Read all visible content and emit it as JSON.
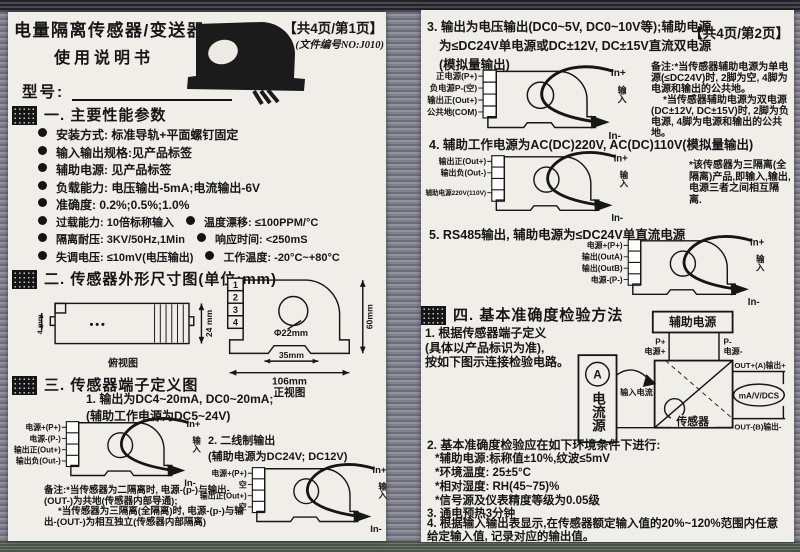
{
  "p1": {
    "title": "电量隔离传感器/变送器",
    "subtitle": "使用说明书",
    "badge": "【共4页/第1页】",
    "docno": "(文件编号NO:J010)",
    "model": "型号:",
    "s1": {
      "h": "一. 主要性能参数",
      "r1": "安装方式: 标准导轨+平面螺钉固定",
      "r2": "输入输出规格:见产品标签",
      "r3": "辅助电源: 见产品标签",
      "r4": "负载能力: 电压输出-5mA;电流输出-6V",
      "r5": "准确度: 0.2%;0.5%;1.0%",
      "r6a": "过载能力: 10倍标称输入",
      "r6b": "温度漂移: ≤100PPM/°C",
      "r7a": "隔离耐压: 3KV/50Hz,1Min",
      "r7b": "响应时间: <250mS",
      "r8a": "失调电压: ≤10mV(电压输出)",
      "r8b": "工作温度: -20°C~+80°C"
    },
    "s2": {
      "h": "二. 传感器外形尺寸图(单位:mm)",
      "side": {
        "d1": "4 mm",
        "d2": "24 mm",
        "cap": "俯视图"
      },
      "front": {
        "hole": "Φ22mm",
        "notch": "35mm",
        "w": "106mm",
        "h": "60mm",
        "cap": "正视图",
        "t1": "1",
        "t2": "2",
        "t3": "3",
        "t4": "4"
      }
    },
    "s3": {
      "h": "三. 传感器端子定义图",
      "d1": {
        "t1": "1. 输出为DC4~20mA, DC0~20mA;",
        "t2": "(辅助工作电源为DC5~24V)",
        "p1": "电源+(P+)",
        "p2": "电源-(P-)",
        "p3": "输出正(Out+)",
        "p4": "输出负(Out-)",
        "inp": "In+",
        "inm": "In-",
        "dir": "输入",
        "n1": "备注:*当传感器为二隔离时, 电源-(p-)与输出-(OUT-)为共地(传感器内部导通);",
        "n2": "*当传感器为三隔离(全隔离)时, 电源-(p-)与输出-(OUT-)为相互独立(传感器内部隔离)"
      },
      "d2": {
        "t1": "2. 二线制输出",
        "t2": "(辅助电源为DC24V; DC12V)",
        "p1": "电源+(P+)",
        "p2": "空",
        "p3": "输出正(Out+)",
        "p4": "空",
        "inp": "In+",
        "inm": "In-",
        "dir": "输入"
      }
    }
  },
  "p2": {
    "badge": "【共4页/第2页】",
    "d3": {
      "t1": "3. 输出为电压输出(DC0~5V, DC0~10V等);辅助电源",
      "t2": "为≤DC24V单电源或DC±12V, DC±15V直流双电源",
      "t3": "(模拟量输出)",
      "p1": "正电源(P+)",
      "p2": "负电源P-(空)",
      "p3": "输出正(Out+)",
      "p4": "公共地(COM)",
      "inp": "In+",
      "inm": "In-",
      "dir": "输入",
      "n1": "备注:*当传感器辅助电源为单电源(≤DC24V)时, 2脚为空, 4脚为电源和输出的公共地。",
      "n2": "*当传感器辅助电源为双电源(DC±12V, DC±15V)时, 2脚为负电源, 4脚为电源和输出的公共地。"
    },
    "d4": {
      "t1": "4. 辅助工作电源为AC(DC)220V, AC(DC)110V(模拟量输出)",
      "p1": "输出正(Out+)",
      "p2": "输出负(Out-)",
      "p3": "辅助电源220V(110V)",
      "inp": "In+",
      "inm": "In-",
      "dir": "输入",
      "n1": "*该传感器为三隔离(全隔离)产品,即输入,输出,电源三者之间相互隔离."
    },
    "d5": {
      "t1": "5. RS485输出, 辅助电源为≤DC24V单直流电源",
      "p1": "电源+(P+)",
      "p2": "输出(OutA)",
      "p3": "输出(OutB)",
      "p4": "电源-(P-)",
      "inp": "In+",
      "inm": "In-",
      "dir": "输入"
    },
    "s4": {
      "h": "四. 基本准确度检验方法",
      "i1a": "1. 根据传感器端子定义",
      "i1b": "(具体以产品标识为准),",
      "i1c": "按如下图示连接检验电路。",
      "dg": {
        "aux": "辅助电源",
        "pp": "P+",
        "ppl": "电源+",
        "pm": "P-",
        "pml": "电源-",
        "amm": "A",
        "src": "电流源",
        "cur": "输入电流",
        "sen": "传感器",
        "outp": "OUT+(A)输出+",
        "outm": "OUT-(B)输出-",
        "meter": "mA/V/DCS"
      },
      "i2": "2. 基本准确度检验应在如下环境条件下进行:",
      "i2a": "*辅助电源:标称值±10%,纹波≤5mV",
      "i2b": "*环境温度: 25±5°C",
      "i2c": "*相对湿度: RH(45~75)%",
      "i2d": "*信号源及仪表精度等级为0.05级",
      "i3": "3. 通电预热3分钟",
      "i4": "4. 根据输入输出表显示,在传感器额定输入值的20%~120%范围内任意给定输入值, 记录对应的输出值。"
    }
  }
}
